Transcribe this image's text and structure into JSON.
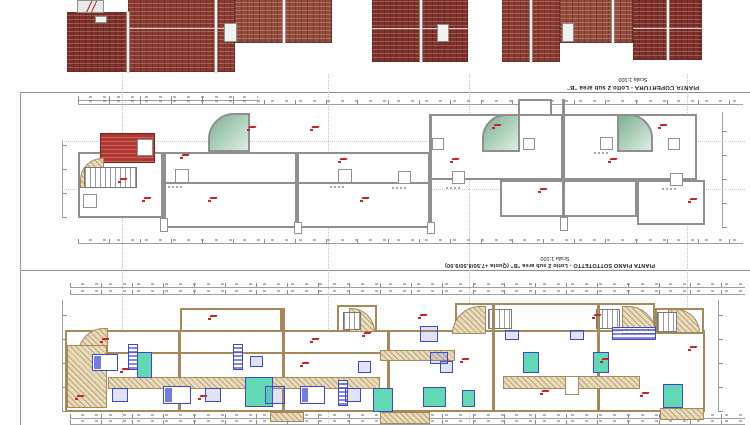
{
  "sheet": {
    "roof_plan": {
      "title": "PIANTA COPERTURA - Lotto 2 sub area \"B\"",
      "scale": "Scala 1:100"
    },
    "attic_plan": {
      "title": "PIANTA PIANO SOTTOTETTO - Lotto 2 sub area \"B\" (Quota +7.50/8.50/9.00)",
      "scale": "Scala 1:100"
    }
  },
  "colors": {
    "roof_tile": "#7e2f28",
    "stair_tower_roof_red": "#b23630",
    "terrace_green": "#8fbfa0",
    "attic_wall_grey": "#8f8f8f",
    "lower_wall_tan": "#a5895b",
    "balcony_floor_tan": "#e9dcbd",
    "bathroom_teal": "#63d8b5",
    "furniture_blue": "#3f48c8",
    "room_tag_red": "#c2262b",
    "dimension_grey": "#9a9a9a"
  }
}
